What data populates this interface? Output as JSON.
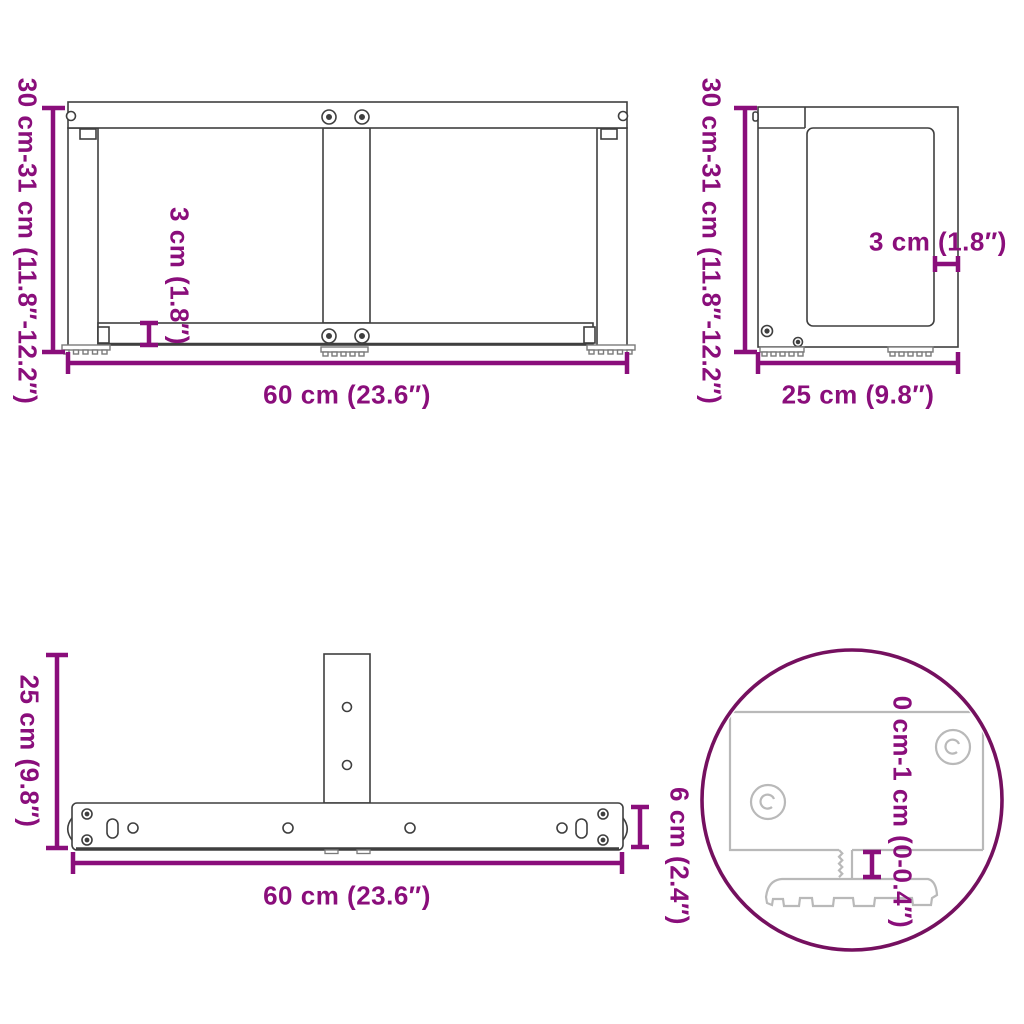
{
  "image_type": "product-dimension-diagram",
  "subject": "T-shaped table leg frame technical drawing, four views",
  "colors": {
    "dimension_text": "#8a0e7b",
    "dimension_line": "#8a0e7b",
    "detail_circle_stroke": "#75105f",
    "drawing_line": "#3f3f3f",
    "light_detail_line": "#b9b9b9",
    "background": "#ffffff"
  },
  "views": {
    "front": {
      "height": "30 cm-31 cm (11.8″-12.2″)",
      "bar_thickness": "3 cm (1.8″)",
      "width": "60 cm (23.6″)"
    },
    "side": {
      "height": "30 cm-31 cm (11.8″-12.2″)",
      "wall_thickness": "3 cm (1.8″)",
      "depth": "25 cm (9.8″)"
    },
    "top": {
      "depth": "25 cm (9.8″)",
      "width": "60 cm (23.6″)",
      "bar_depth": "6 cm (2.4″)"
    },
    "detail": {
      "foot_adjustment": "0 cm-1 cm (0-0.4″)"
    }
  }
}
